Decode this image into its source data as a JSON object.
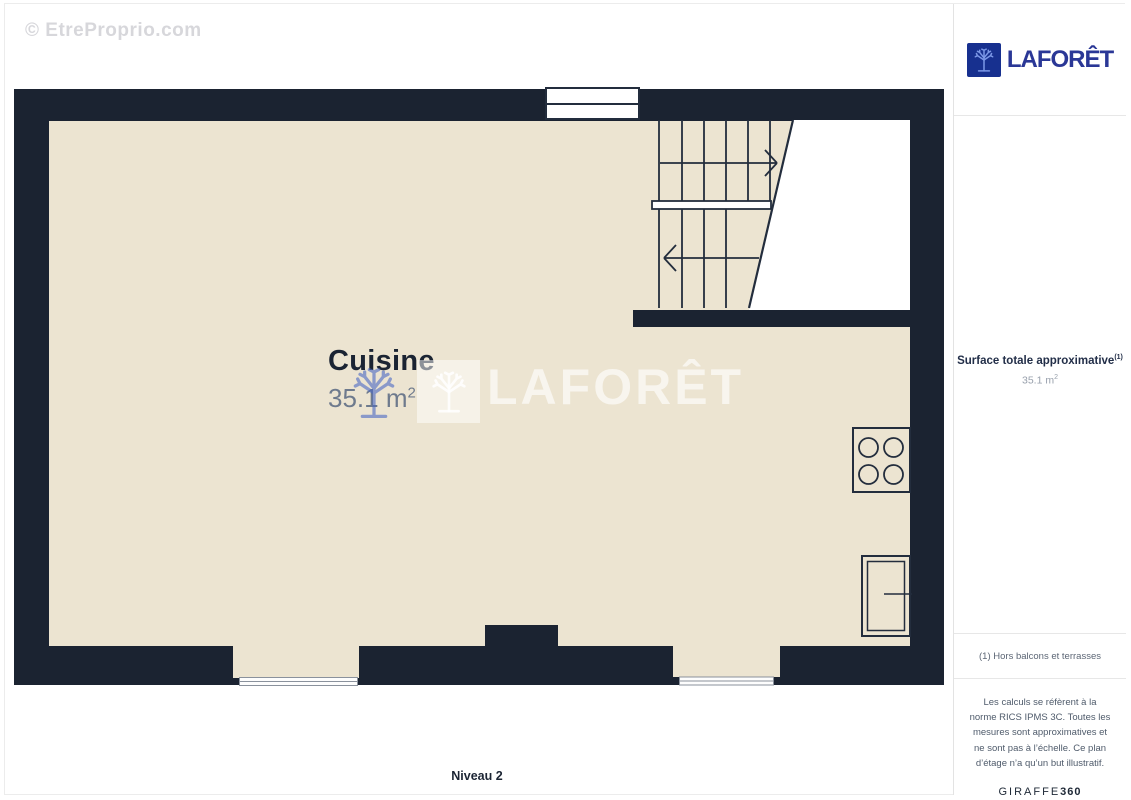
{
  "page": {
    "watermark": "© EtreProprio.com",
    "level_label": "Niveau 2"
  },
  "plan": {
    "room": {
      "name": "Cuisine",
      "area_value": "35.1 m",
      "area_sup": "2"
    },
    "center_watermark_text": "LAFORÊT"
  },
  "sidebar": {
    "logo_text": "LAFORÊT",
    "surface_label": "Surface totale approximative",
    "surface_footnote": "(1)",
    "surface_value": "35.1 m",
    "surface_value_sup": "2",
    "note": "(1) Hors balcons et terrasses",
    "legal": "Les calculs se réfèrent à la norme RICS IPMS 3C. Toutes les mesures sont approximatives et ne sont pas à l’échelle. Ce plan d’étage n’a qu’un but illustratif.",
    "brand_name": "GIRAFFE",
    "brand_suffix": "360"
  },
  "colors": {
    "wall": "#1b2331",
    "floor": "#ece4d1",
    "logo_square_blue": "#17308f",
    "logo_text_blue": "#2a3796",
    "text_dark": "#1b2433",
    "muted_gray": "#98a0ac"
  }
}
